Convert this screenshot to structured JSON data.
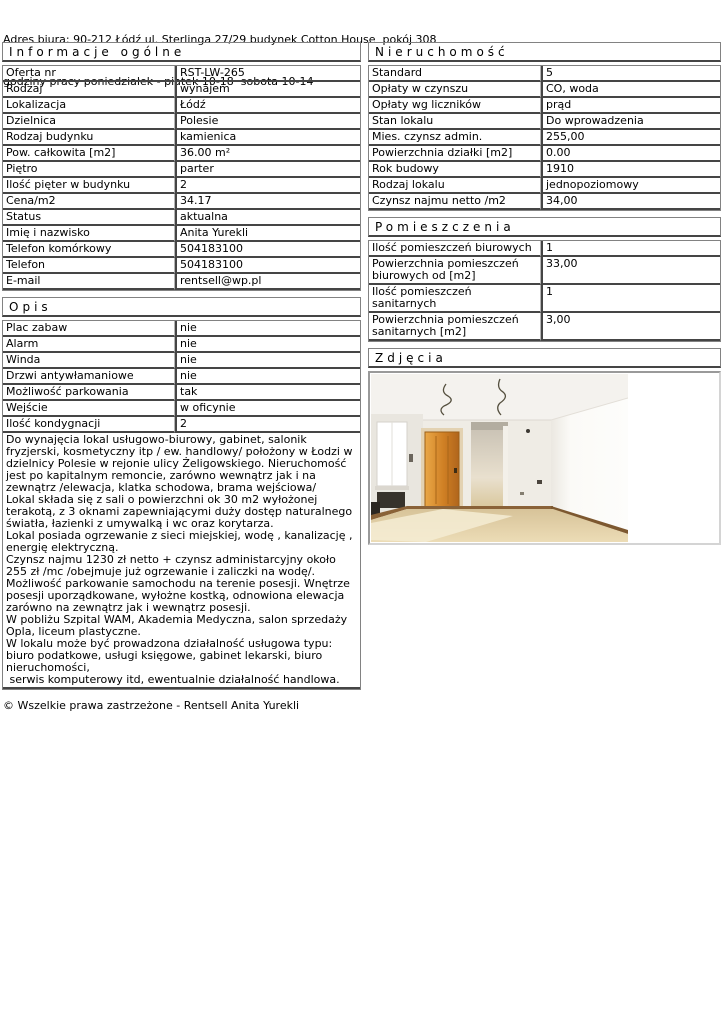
{
  "page": {
    "address_line1": "Adres biura: 90-212 Łódź ul. Sterlinga 27/29 budynek Cotton House  pokój 308",
    "address_line2": "godziny pracy poniedziałek - piatek 10-18  sobota 10-14",
    "footer": "© Wszelkie prawa zastrzeżone - Rentsell Anita Yurekli"
  },
  "sections": {
    "general": {
      "title": "Informacje ogólne",
      "rows": [
        {
          "label": "Oferta nr",
          "value": "RST-LW-265"
        },
        {
          "label": "Rodzaj",
          "value": "wynajem"
        },
        {
          "label": "Lokalizacja",
          "value": "Łódź"
        },
        {
          "label": "Dzielnica",
          "value": "Polesie"
        },
        {
          "label": "Rodzaj budynku",
          "value": "kamienica"
        },
        {
          "label": "Pow. całkowita [m2]",
          "value": "36.00 m²"
        },
        {
          "label": "Piętro",
          "value": "parter"
        },
        {
          "label": "Ilość pięter w budynku",
          "value": "2"
        },
        {
          "label": "Cena/m2",
          "value": "34.17"
        },
        {
          "label": "Status",
          "value": "aktualna"
        },
        {
          "label": "Imię i nazwisko",
          "value": "Anita Yurekli"
        },
        {
          "label": "Telefon komórkowy",
          "value": "504183100"
        },
        {
          "label": "Telefon",
          "value": "504183100"
        },
        {
          "label": "E-mail",
          "value": "rentsell@wp.pl"
        }
      ]
    },
    "opis": {
      "title": "Opis",
      "rows": [
        {
          "label": "Plac zabaw",
          "value": "nie"
        },
        {
          "label": "Alarm",
          "value": "nie"
        },
        {
          "label": "Winda",
          "value": "nie"
        },
        {
          "label": "Drzwi antywłamaniowe",
          "value": "nie"
        },
        {
          "label": "Możliwość parkowania",
          "value": "tak"
        },
        {
          "label": "Wejście",
          "value": "w oficynie"
        },
        {
          "label": "Ilość kondygnacji",
          "value": "2"
        }
      ],
      "description": "Do wynajęcia lokal usługowo-biurowy, gabinet, salonik fryzjerski, kosmetyczny itp / ew. handlowy/ położony w Łodzi w dzielnicy Polesie w rejonie ulicy Żeligowskiego. Nieruchomość jest po kapitalnym remoncie, zarówno wewnątrz jak i na zewnątrz /elewacja, klatka schodowa, brama wejściowa/\nLokal składa się z sali o powierzchni ok 30 m2 wyłożonej terakotą, z 3 oknami zapewniającymi duży dostęp naturalnego światła, łazienki z umywalką i wc oraz korytarza.\nLokal posiada ogrzewanie z sieci miejskiej, wodę , kanalizację , energię elektryczną.\nCzynsz najmu 1230 zł netto + czynsz administarcyjny około 255 zł /mc /obejmuje już ogrzewanie i zaliczki na wodę/.\nMożliwość parkowanie samochodu na terenie posesji. Wnętrze posesji uporządkowane, wyłożne kostką, odnowiona elewacja zarówno na zewnątrz jak i wewnątrz posesji.\nW pobliżu Szpital WAM, Akademia Medyczna, salon sprzedaży Opla, liceum plastyczne.\nW lokalu może być prowadzona działalność usługowa typu: biuro podatkowe, usługi księgowe, gabinet lekarski, biuro nieruchomości,\n serwis komputerowy itd, ewentualnie działalność handlowa."
    },
    "nieruchomosc": {
      "title": "Nieruchomość",
      "rows": [
        {
          "label": "Standard",
          "value": "5"
        },
        {
          "label": "Opłaty w czynszu",
          "value": "CO, woda"
        },
        {
          "label": "Opłaty wg liczników",
          "value": "prąd"
        },
        {
          "label": "Stan lokalu",
          "value": "Do wprowadzenia"
        },
        {
          "label": "Mies. czynsz admin.",
          "value": "255,00"
        },
        {
          "label": "Powierzchnia działki [m2]",
          "value": "0.00"
        },
        {
          "label": "Rok budowy",
          "value": "1910"
        },
        {
          "label": "Rodzaj lokalu",
          "value": "jednopoziomowy"
        },
        {
          "label": "Czynsz najmu netto /m2",
          "value": "34,00"
        }
      ]
    },
    "pomieszczenia": {
      "title": "Pomieszczenia",
      "rows": [
        {
          "label": "Ilość pomieszczeń biurowych",
          "value": "1"
        },
        {
          "label": "Powierzchnia pomieszczeń biurowych od [m2]",
          "value": "33,00"
        },
        {
          "label": "Ilość pomieszczeń sanitarnych",
          "value": "1"
        },
        {
          "label": "Powierzchnia pomieszczeń sanitarnych [m2]",
          "value": "3,00"
        }
      ]
    },
    "zdjecia": {
      "title": "Zdjęcia",
      "photo_name": "empty-renovated-room-photo"
    }
  }
}
